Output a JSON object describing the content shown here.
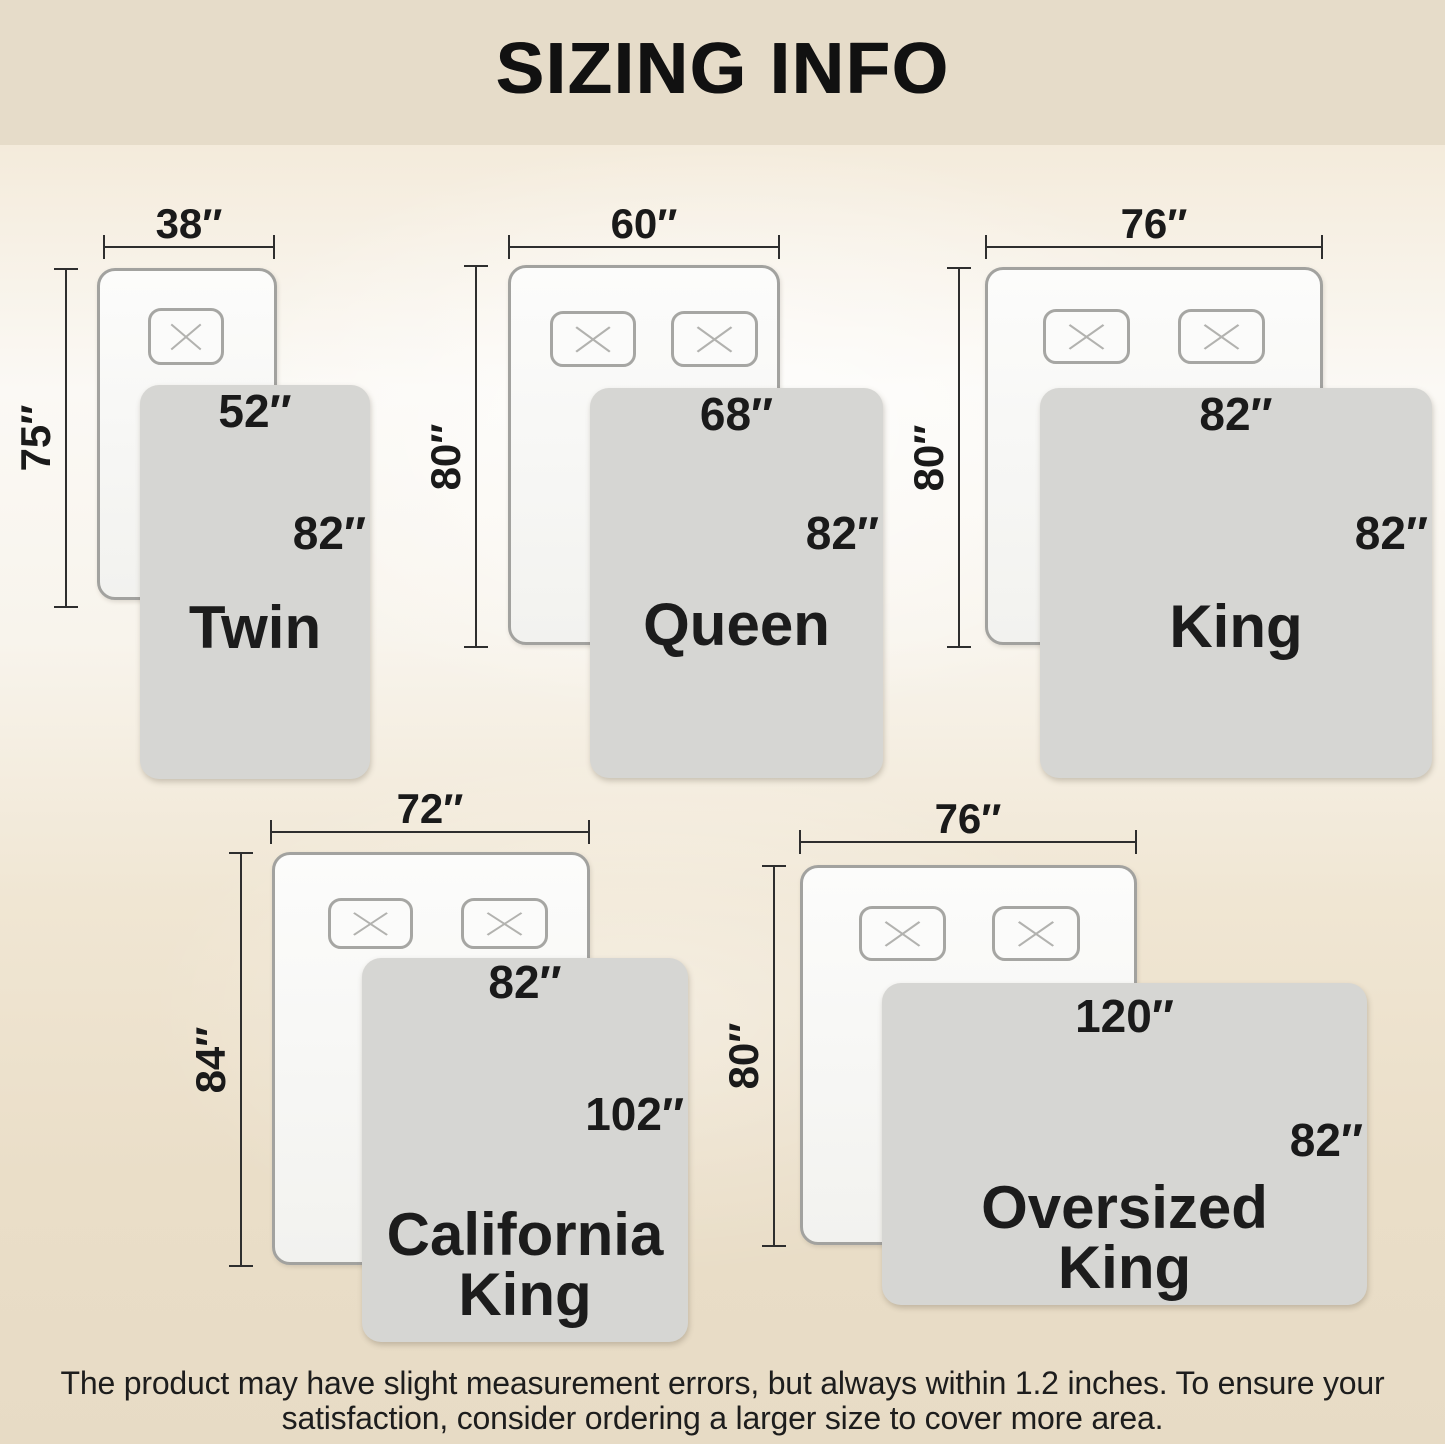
{
  "header": {
    "title": "SIZING INFO"
  },
  "sizes": [
    {
      "name": "Twin",
      "name_lines": [
        "Twin"
      ],
      "bed_width": "38″",
      "bed_length": "75″",
      "blanket_width": "52″",
      "blanket_length": "82″",
      "pillow_count": 1
    },
    {
      "name": "Queen",
      "name_lines": [
        "Queen"
      ],
      "bed_width": "60″",
      "bed_length": "80″",
      "blanket_width": "68″",
      "blanket_length": "82″",
      "pillow_count": 2
    },
    {
      "name": "King",
      "name_lines": [
        "King"
      ],
      "bed_width": "76″",
      "bed_length": "80″",
      "blanket_width": "82″",
      "blanket_length": "82″",
      "pillow_count": 2
    },
    {
      "name": "California King",
      "name_lines": [
        "California",
        "King"
      ],
      "bed_width": "72″",
      "bed_length": "84″",
      "blanket_width": "82″",
      "blanket_length": "102″",
      "pillow_count": 2
    },
    {
      "name": "Oversized King",
      "name_lines": [
        "Oversized",
        "King"
      ],
      "bed_width": "76″",
      "bed_length": "80″",
      "blanket_width": "120″",
      "blanket_length": "82″",
      "pillow_count": 2
    }
  ],
  "footer": {
    "line1": "The product may have slight measurement errors, but always within 1.2 inches. To ensure your",
    "line2": "satisfaction, consider ordering a larger size to cover more area."
  },
  "colors": {
    "header_bg": "#e6dcc9",
    "background_bottom": "#e7dbc5",
    "bed_fill": "#f8f8f6",
    "bed_border": "#a2a29f",
    "blanket_fill": "#d6d6d3",
    "dimension_line": "#2e2e2e",
    "text": "#1a1a1a"
  }
}
